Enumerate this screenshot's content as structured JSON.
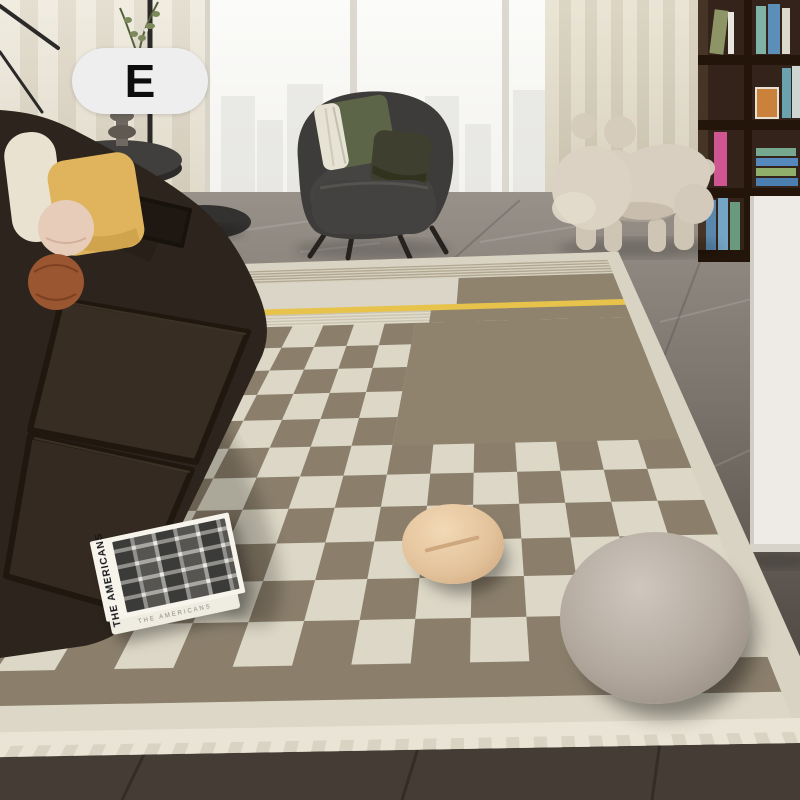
{
  "badge": {
    "label": "E",
    "bg": "#eeeeee",
    "text_color": "#0d0d0d"
  },
  "book": {
    "title": "THE AMERICANS",
    "cover_color": "#f7f4ec"
  },
  "scene": {
    "objects": [
      {
        "name": "leather-sofa",
        "color": "#2c241d"
      },
      {
        "name": "throw-pillow-cream",
        "color": "#e9e2d1"
      },
      {
        "name": "throw-pillow-yellow",
        "color": "#dfb45c"
      },
      {
        "name": "throw-pillow-pink-round",
        "color": "#e7ccba"
      },
      {
        "name": "throw-pillow-rust-ball",
        "color": "#9a5531"
      },
      {
        "name": "armchair",
        "color": "#3d3c3a"
      },
      {
        "name": "dog-sculpture",
        "color": "#d8cfc0"
      },
      {
        "name": "round-cushion-beige",
        "color": "#e3c29a"
      },
      {
        "name": "round-cushion-gray",
        "color": "#b2a89e"
      },
      {
        "name": "bookshelf",
        "color": "#33231a"
      },
      {
        "name": "white-cabinet",
        "color": "#eeebe6"
      },
      {
        "name": "marble-floor",
        "color": "#7a736b"
      }
    ]
  },
  "rug": {
    "quad": {
      "tl": [
        187,
        266
      ],
      "tr": [
        618,
        252
      ],
      "br": [
        838,
        742
      ],
      "bl": [
        -300,
        762
      ]
    },
    "foreshorten": 1.8,
    "border_color": "#d9d3c3",
    "accent_yellow": "#e7c34c",
    "checker_taupe": "#8b7f6c",
    "checker_cream": "#dcd7c6",
    "sections": [
      {
        "name": "base-border",
        "u": [
          0,
          1
        ],
        "v": [
          0,
          1
        ],
        "color": "#d9d3c3"
      },
      {
        "name": "stripe-band",
        "type": "hstripes",
        "u": [
          0.032,
          0.968
        ],
        "v": [
          0.028,
          0.075
        ],
        "colors": [
          "#b2a791",
          "#d7d1c0"
        ],
        "count": 10
      },
      {
        "name": "panel-light",
        "u": [
          0.032,
          0.635
        ],
        "v": [
          0.075,
          0.16
        ],
        "color": "#dad5c6"
      },
      {
        "name": "panel-taupe",
        "u": [
          0.635,
          0.968
        ],
        "v": [
          0.075,
          0.16
        ],
        "color": "#8f836e"
      },
      {
        "name": "yellow-line",
        "u": [
          0.032,
          0.968
        ],
        "v": [
          0.16,
          0.178
        ],
        "color": "#e7c34c"
      },
      {
        "name": "thin-stripes",
        "type": "hstripes",
        "u": [
          0.032,
          0.585
        ],
        "v": [
          0.178,
          0.215
        ],
        "colors": [
          "#ccc5b2",
          "#e1dccd"
        ],
        "count": 8
      },
      {
        "name": "block-upper",
        "u": [
          0.585,
          0.968
        ],
        "v": [
          0.178,
          0.215
        ],
        "color": "#8f836e"
      },
      {
        "name": "checkerboard",
        "type": "checker",
        "u": [
          0.032,
          0.968
        ],
        "v": [
          0.215,
          0.895
        ],
        "cols": 16,
        "rows": 11,
        "colors": [
          "#8b7f6c",
          "#dcd7c6"
        ]
      },
      {
        "name": "block-overlay",
        "u": [
          0.5585,
          0.968
        ],
        "v": [
          0.215,
          0.524
        ],
        "color": "#8f836e"
      },
      {
        "name": "bottom-band",
        "u": [
          0.032,
          0.968
        ],
        "v": [
          0.895,
          0.94
        ],
        "color": "#8b7f6c"
      },
      {
        "name": "bottom-border",
        "u": [
          0.032,
          0.968
        ],
        "v": [
          0.94,
          0.972
        ],
        "color": "#dcd7c6"
      },
      {
        "name": "fringe",
        "type": "fringe",
        "u": [
          0.01,
          0.99
        ],
        "v": [
          0.972,
          1.0
        ],
        "color": "#e9e4d5",
        "ticks": 80
      }
    ]
  }
}
